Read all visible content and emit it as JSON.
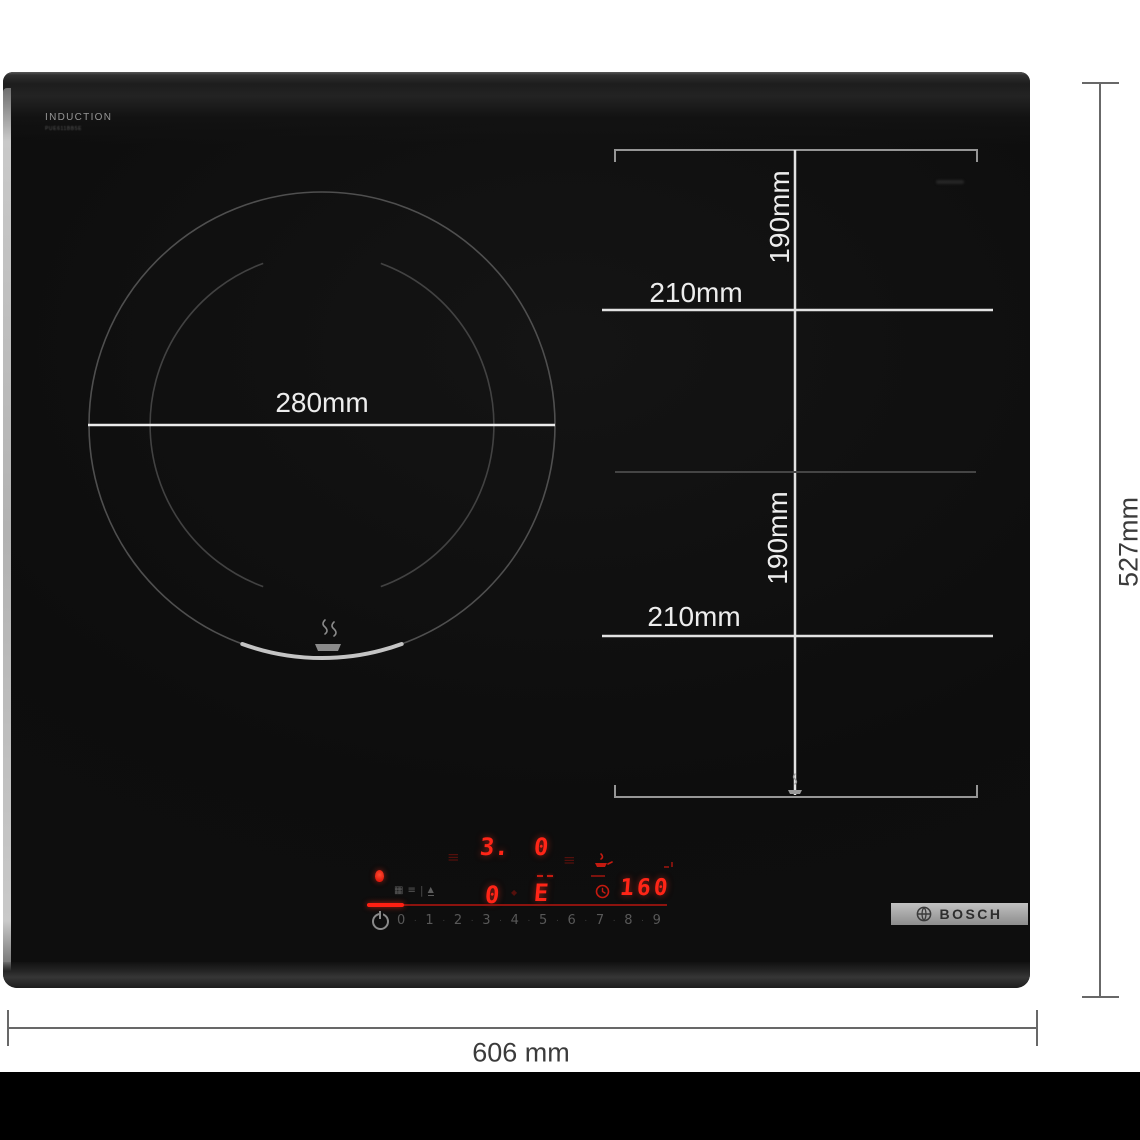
{
  "product": {
    "surface_label": "INDUCTION",
    "model_label": "PUE611BB5E",
    "brand": "BOSCH"
  },
  "zone_dimensions": {
    "main_zone_diameter": "280mm",
    "flex_zone_top": {
      "depth": "190mm",
      "width": "210mm"
    },
    "flex_zone_bottom": {
      "depth": "190mm",
      "width": "210mm"
    }
  },
  "overall_dimensions": {
    "width": "606 mm",
    "depth": "527mm"
  },
  "control_panel": {
    "zone_display_top_left": "3.",
    "zone_display_top_right": "0",
    "zone_display_bottom_left": "0",
    "zone_display_bottom_right": "E",
    "timer_display": "160",
    "ghost_segments": "≡",
    "pause_icon_glyph": "▦",
    "menu_icon_glyph": "≡",
    "divider_glyph": "|",
    "lift_icon_glyph": "▲",
    "power_level_scale": [
      "0",
      "1",
      "2",
      "3",
      "4",
      "5",
      "6",
      "7",
      "8",
      "9"
    ],
    "dot_separator": "·"
  },
  "colors": {
    "display_red": "#ff2517",
    "slider_line_red": "#8c130e",
    "glass_black": "#0d0d0d",
    "marking_white": "#ededed"
  }
}
